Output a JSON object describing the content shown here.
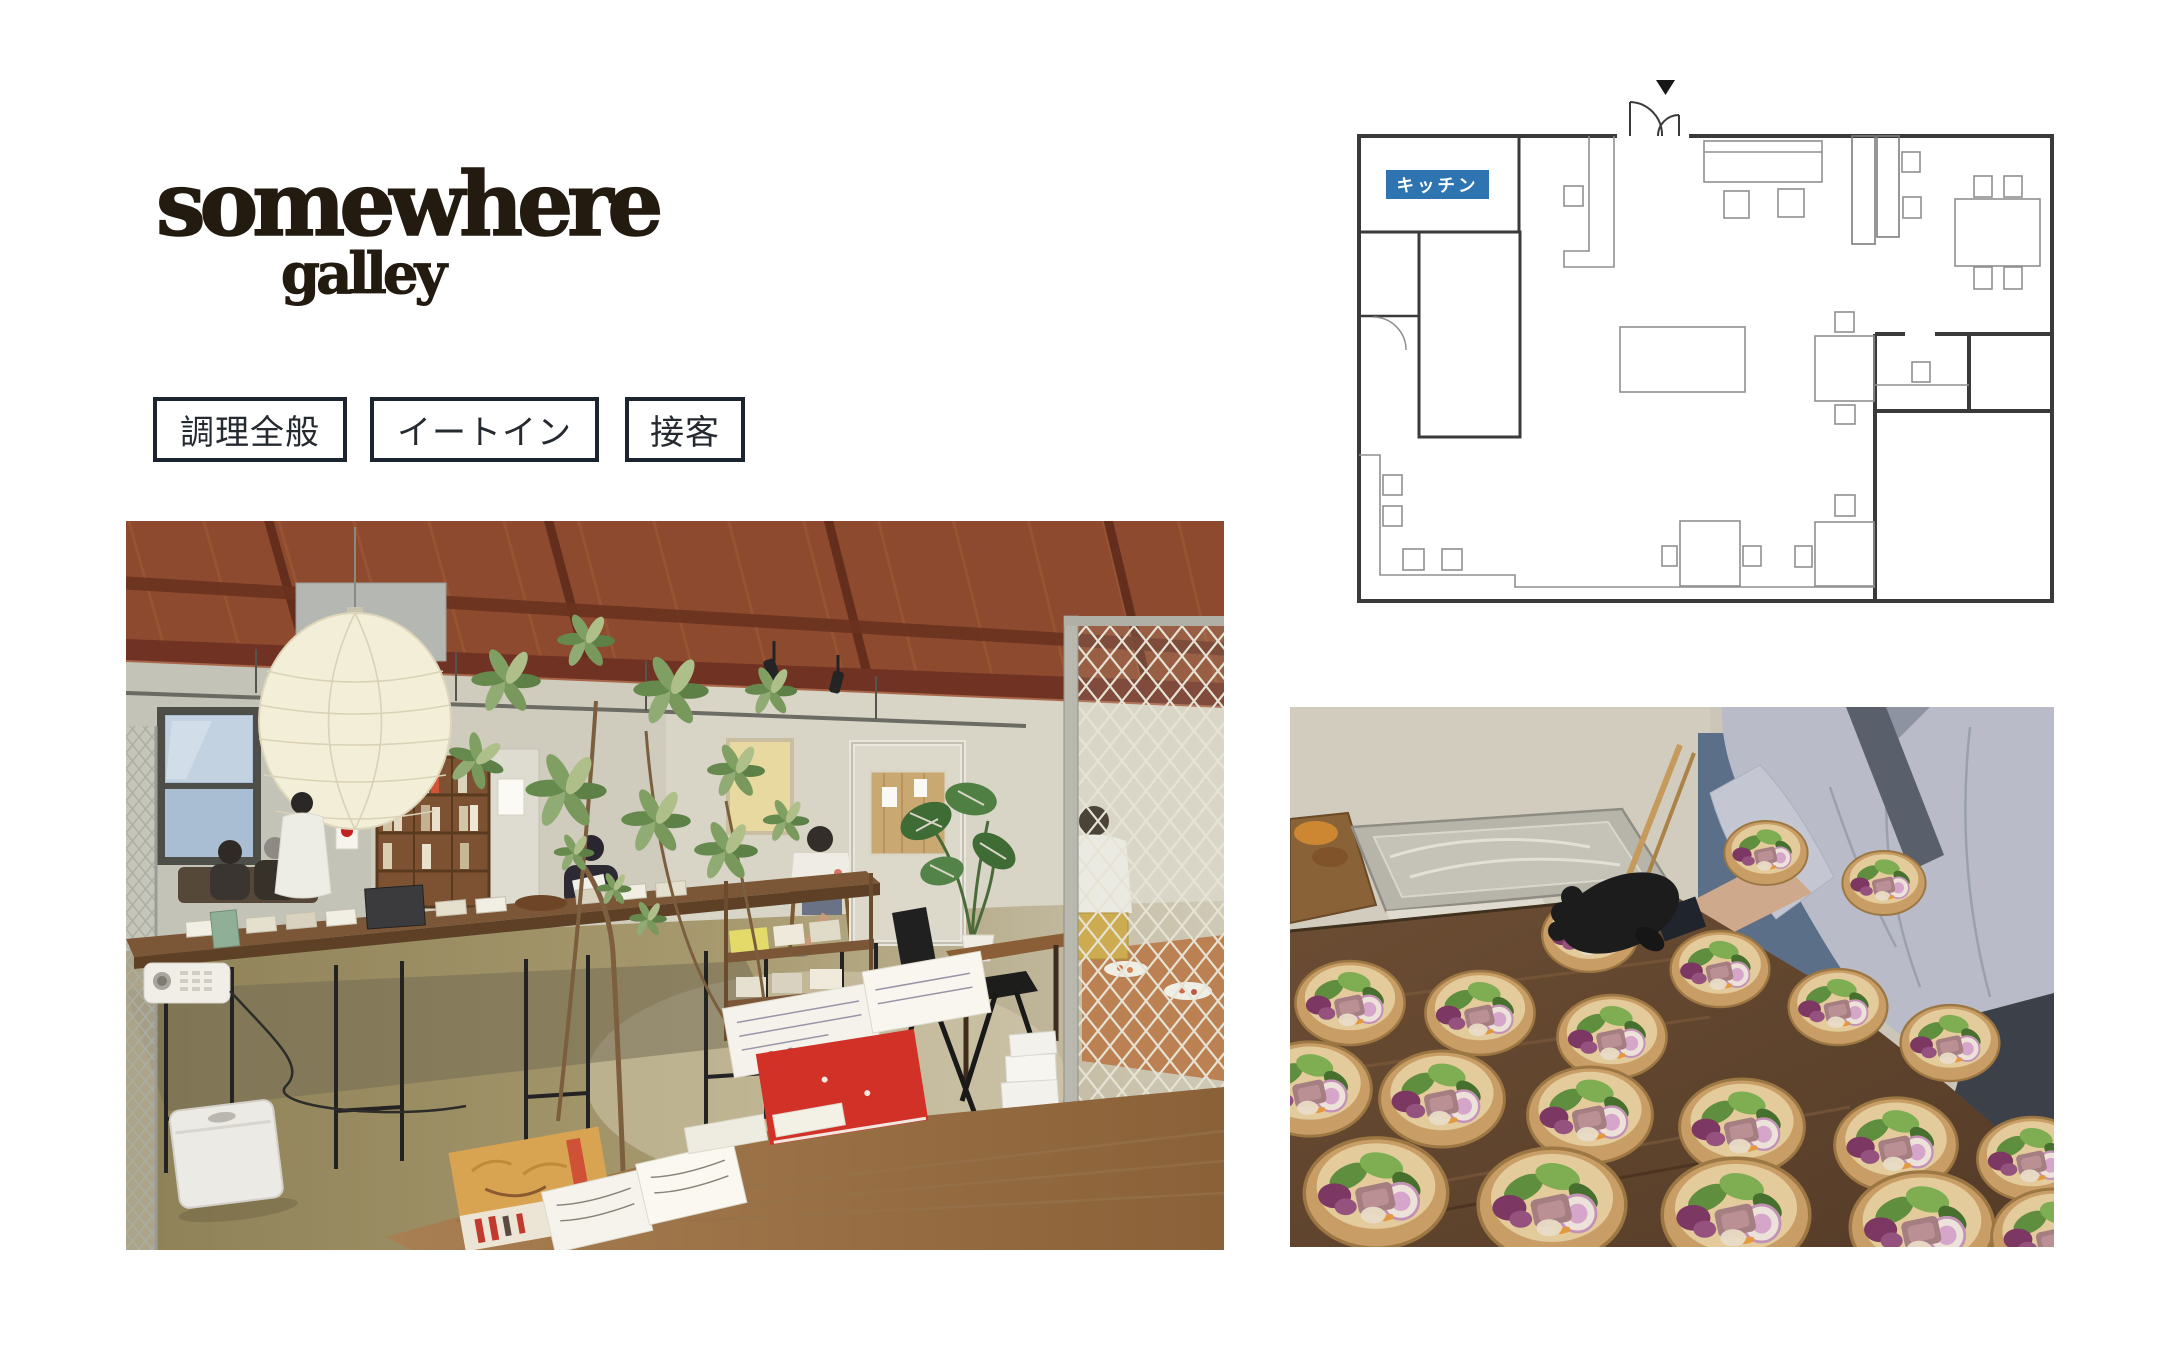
{
  "page": {
    "background": "#ffffff"
  },
  "logo": {
    "line1": "somewhere",
    "line2": "galley",
    "color": "#231a10"
  },
  "tags": {
    "border_color": "#1c2430",
    "text_color": "#252a31",
    "items": [
      {
        "label": "調理全般"
      },
      {
        "label": "イートイン"
      },
      {
        "label": "接客"
      }
    ]
  },
  "floor_plan": {
    "kitchen_label": "キッチン",
    "kitchen_label_bg": "#2e74b1",
    "kitchen_label_text_color": "#ffffff",
    "wall_color": "#3a3a3a",
    "furniture_color": "#8f8f8f",
    "entrance_marker_color": "#171717"
  },
  "photos": {
    "left": {
      "name": "gallery-cafe-interior-photo"
    },
    "right": {
      "name": "salad-bowls-preparation-photo"
    }
  }
}
